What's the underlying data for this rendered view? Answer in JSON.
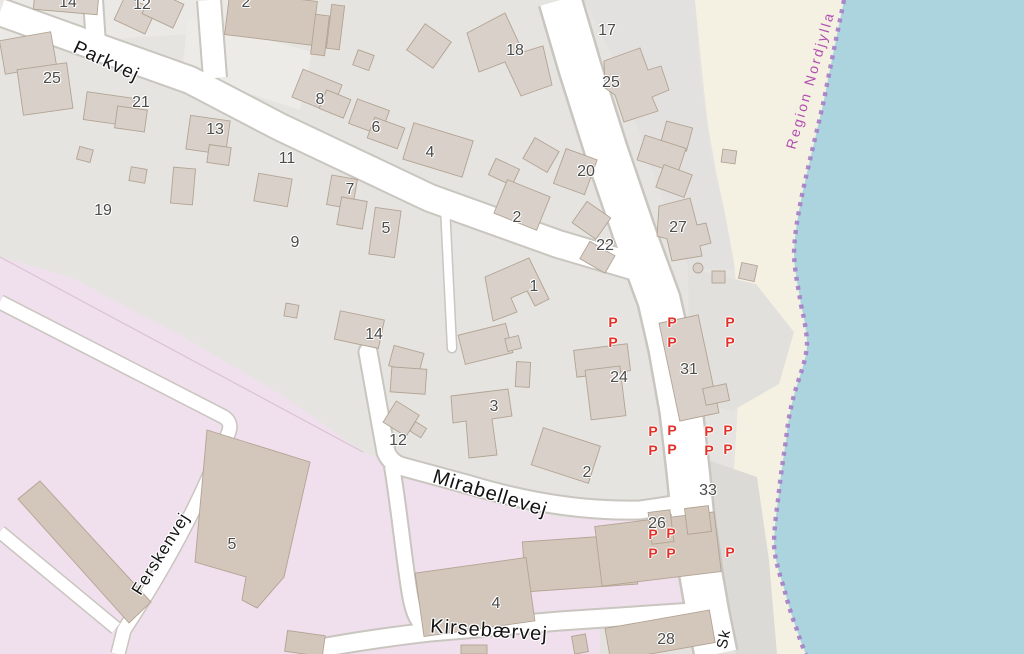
{
  "map": {
    "style": "openstreetmap",
    "region_boundary_label": {
      "text": "Region Nordjylla",
      "x": 810,
      "y": 80,
      "rot": -74,
      "color": "#b14fb1"
    },
    "streets": [
      {
        "label": "Parkvej",
        "x": 106,
        "y": 62,
        "rot": 25,
        "size": 19
      },
      {
        "label": "Mirabellevej",
        "x": 490,
        "y": 494,
        "rot": 17,
        "size": 20
      },
      {
        "label": "Kirsebærvej",
        "x": 489,
        "y": 631,
        "rot": 4,
        "size": 20
      },
      {
        "label": "Ferskenvej",
        "x": 161,
        "y": 554,
        "rot": -58,
        "size": 17
      },
      {
        "label": "Sk",
        "x": 724,
        "y": 639,
        "rot": -78,
        "size": 15
      }
    ],
    "house_numbers": [
      {
        "t": "14",
        "x": 68,
        "y": 3
      },
      {
        "t": "12",
        "x": 142,
        "y": 5
      },
      {
        "t": "2",
        "x": 246,
        "y": 3
      },
      {
        "t": "25",
        "x": 52,
        "y": 79
      },
      {
        "t": "21",
        "x": 141,
        "y": 103
      },
      {
        "t": "13",
        "x": 215,
        "y": 130
      },
      {
        "t": "11",
        "x": 287,
        "y": 159
      },
      {
        "t": "19",
        "x": 103,
        "y": 211
      },
      {
        "t": "9",
        "x": 295,
        "y": 243
      },
      {
        "t": "8",
        "x": 320,
        "y": 100
      },
      {
        "t": "6",
        "x": 376,
        "y": 128
      },
      {
        "t": "4",
        "x": 430,
        "y": 153
      },
      {
        "t": "7",
        "x": 350,
        "y": 190
      },
      {
        "t": "5",
        "x": 386,
        "y": 229
      },
      {
        "t": "18",
        "x": 515,
        "y": 51
      },
      {
        "t": "2",
        "x": 517,
        "y": 218
      },
      {
        "t": "17",
        "x": 607,
        "y": 31
      },
      {
        "t": "25",
        "x": 611,
        "y": 83
      },
      {
        "t": "20",
        "x": 586,
        "y": 172
      },
      {
        "t": "27",
        "x": 678,
        "y": 228
      },
      {
        "t": "22",
        "x": 605,
        "y": 246
      },
      {
        "t": "1",
        "x": 534,
        "y": 287
      },
      {
        "t": "14",
        "x": 374,
        "y": 335
      },
      {
        "t": "24",
        "x": 619,
        "y": 378
      },
      {
        "t": "31",
        "x": 689,
        "y": 370
      },
      {
        "t": "3",
        "x": 494,
        "y": 407
      },
      {
        "t": "12",
        "x": 398,
        "y": 441
      },
      {
        "t": "2",
        "x": 587,
        "y": 473
      },
      {
        "t": "33",
        "x": 708,
        "y": 491
      },
      {
        "t": "26",
        "x": 657,
        "y": 524
      },
      {
        "t": "5",
        "x": 232,
        "y": 545
      },
      {
        "t": "4",
        "x": 496,
        "y": 604
      },
      {
        "t": "28",
        "x": 666,
        "y": 640
      }
    ],
    "parking": {
      "glyph": "P",
      "color": "#e23229",
      "positions": [
        {
          "x": 613,
          "y": 322
        },
        {
          "x": 613,
          "y": 342
        },
        {
          "x": 672,
          "y": 322
        },
        {
          "x": 672,
          "y": 342
        },
        {
          "x": 730,
          "y": 322
        },
        {
          "x": 730,
          "y": 342
        },
        {
          "x": 653,
          "y": 431
        },
        {
          "x": 672,
          "y": 430
        },
        {
          "x": 653,
          "y": 450
        },
        {
          "x": 672,
          "y": 449
        },
        {
          "x": 709,
          "y": 431
        },
        {
          "x": 728,
          "y": 430
        },
        {
          "x": 709,
          "y": 450
        },
        {
          "x": 728,
          "y": 449
        },
        {
          "x": 653,
          "y": 534
        },
        {
          "x": 671,
          "y": 533
        },
        {
          "x": 653,
          "y": 553
        },
        {
          "x": 671,
          "y": 553
        },
        {
          "x": 730,
          "y": 552
        }
      ]
    },
    "colors": {
      "water": "#abd4de",
      "beach": "#f5f1e2",
      "urban": "#e6e4e1",
      "industrial": "#f0dfec",
      "building": "#d9d0c9",
      "building_dark": "#d3c7bb",
      "road": "#ffffff",
      "admin_boundary": "#a57fc8",
      "parking_red": "#e23229",
      "region_label": "#b14fb1"
    }
  }
}
